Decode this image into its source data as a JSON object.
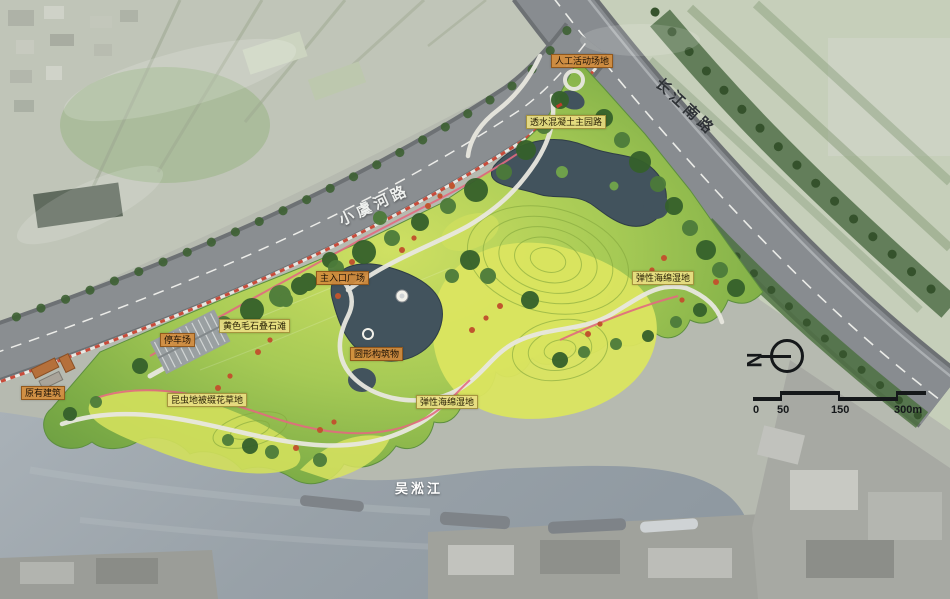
{
  "map": {
    "region_labels": [
      {
        "text": "人工活动场地",
        "type": "orange"
      },
      {
        "text": "透水混凝土主园路",
        "type": "yellow"
      },
      {
        "text": "主入口广场",
        "type": "orange"
      },
      {
        "text": "黄色毛石叠石滩",
        "type": "yellow"
      },
      {
        "text": "停车场",
        "type": "orange"
      },
      {
        "text": "原有建筑",
        "type": "orange"
      },
      {
        "text": "昆虫地被缀花草地",
        "type": "yellow"
      },
      {
        "text": "圆形构筑物",
        "type": "orange"
      },
      {
        "text": "弹性海绵湿地",
        "type": "yellow"
      },
      {
        "text": "弹性海绵湿地",
        "type": "yellow"
      }
    ],
    "roads": [
      {
        "name": "小虞河路"
      },
      {
        "name": "长江南路"
      }
    ],
    "river": {
      "name": "吴淞江"
    },
    "compass": {
      "letter": "N"
    },
    "scale_bar": {
      "ticks": [
        "0",
        "50",
        "150",
        "300m"
      ]
    },
    "palette": {
      "park_green": "#8cbb4f",
      "meadow_yellow": "#d9e25f",
      "pond_water": "#42535d",
      "river_water": "#9aa3ab",
      "road_gray": "#8a8e91",
      "tree_dark_green": "#3a6530",
      "accent_tree_red": "#c0552e",
      "track_pink": "#e26a80"
    }
  }
}
